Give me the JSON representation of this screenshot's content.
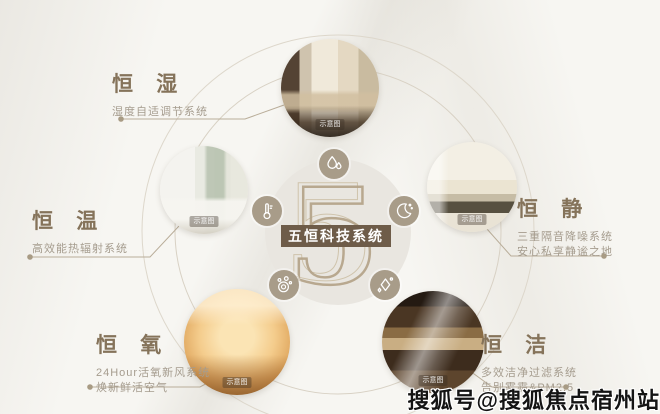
{
  "center": {
    "numeral": "5",
    "title": "五恒科技系统"
  },
  "items": [
    {
      "id": "hengshi",
      "title": "恒 湿",
      "desc1": "湿度自适调节系统",
      "desc2": "",
      "caption": "示意图",
      "icon": "water-drop-icon"
    },
    {
      "id": "hengwen",
      "title": "恒 温",
      "desc1": "高效能热辐射系统",
      "desc2": "",
      "caption": "示意图",
      "icon": "thermometer-icon"
    },
    {
      "id": "hengjing",
      "title": "恒 静",
      "desc1": "三重隔音降噪系统",
      "desc2": "安心私享静谧之地",
      "caption": "示意图",
      "icon": "moon-icon"
    },
    {
      "id": "hengyang",
      "title": "恒 氧",
      "desc1": "24Hour活氧新风系统",
      "desc2": "焕新鲜活空气",
      "caption": "示意图",
      "icon": "oxygen-icon"
    },
    {
      "id": "hengjie",
      "title": "恒 洁",
      "desc1": "多效洁净过滤系统",
      "desc2": "告别雾霾&PM2.5",
      "caption": "示意图",
      "icon": "sparkle-icon"
    }
  ],
  "watermark": "搜狐号@搜狐焦点宿州站",
  "colors": {
    "accent_brown": "#6e5c49",
    "title_brown": "#85735a",
    "desc_gray": "#a59c8e",
    "badge_tan": "#a89c89",
    "ring_line": "#d8d1c4",
    "numeral_outline": "#b3a287",
    "background": "#f7f6f2"
  }
}
